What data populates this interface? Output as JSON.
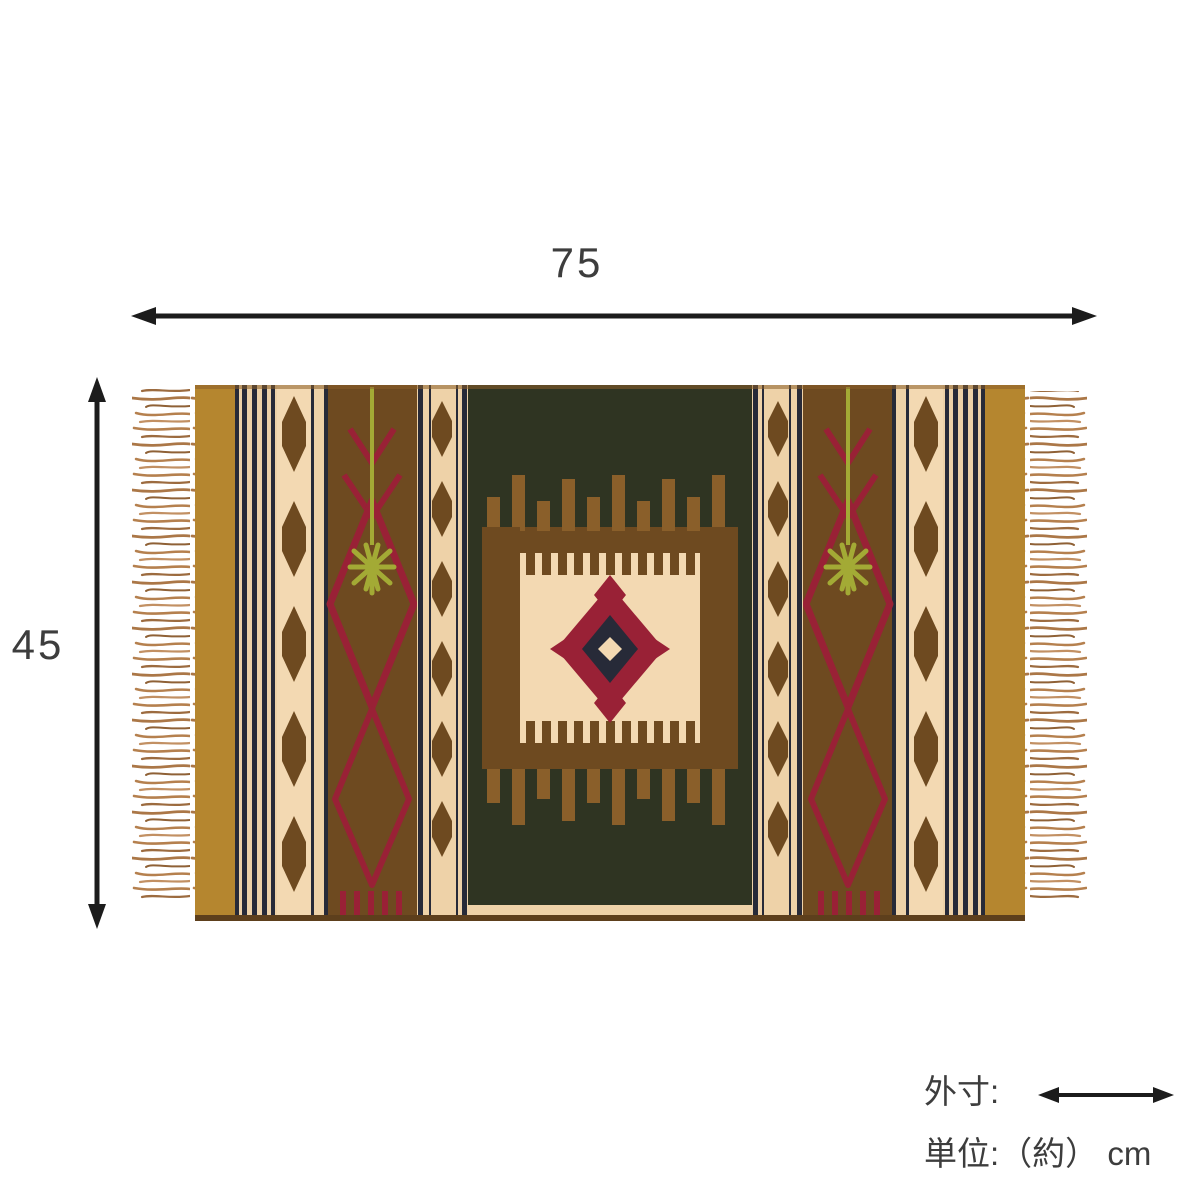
{
  "diagram": {
    "type": "product-dimension-diagram",
    "product": "kilim rug",
    "width_label": "75",
    "height_label": "45",
    "unit": "cm",
    "legend": {
      "outer_dimension_label": "外寸:",
      "unit_label": "単位:（約） cm"
    }
  },
  "icons": {
    "width_arrow": "double-headed-horizontal-arrow",
    "height_arrow": "double-headed-vertical-arrow",
    "legend_arrow": "double-headed-horizontal-arrow"
  },
  "palette": {
    "text": "#3d3d3d",
    "arrow": "#1c1c1c",
    "bg": "#ffffff",
    "gold": "#b5862f",
    "cream": "#eed2a8",
    "cream2": "#f3d9b2",
    "navy": "#272a38",
    "brown": "#6e4a20",
    "brown2": "#8a5f2a",
    "darkbrown": "#5d3f1c",
    "green": "#2f3422",
    "olive": "#a3aa35",
    "red": "#992136",
    "tan1": "#b5804e",
    "tan2": "#9c6b3f",
    "tan3": "#ab7747",
    "tan4": "#8f6136",
    "tan5": "#c29063"
  }
}
